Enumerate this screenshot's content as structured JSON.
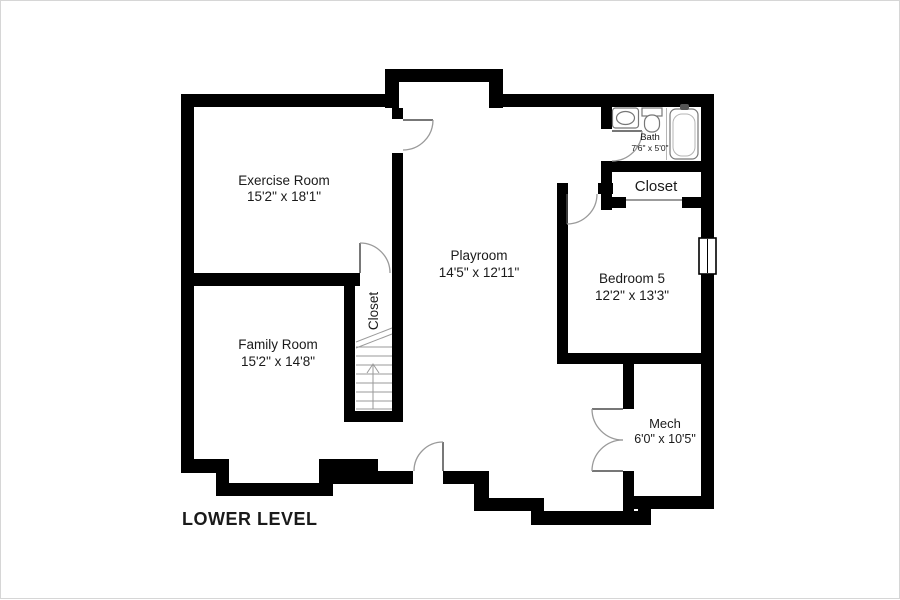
{
  "title": "LOWER LEVEL",
  "colors": {
    "wall": "#000000",
    "background": "#ffffff",
    "door": "#9a9a9a",
    "fixture": "#777777",
    "text": "#1a1a1a"
  },
  "rooms": {
    "exercise": {
      "name": "Exercise Room",
      "dims": "15'2\" x 18'1\""
    },
    "playroom": {
      "name": "Playroom",
      "dims": "14'5\" x 12'11\""
    },
    "family": {
      "name": "Family Room",
      "dims": "15'2\" x 14'8\""
    },
    "bedroom5": {
      "name": "Bedroom 5",
      "dims": "12'2\" x 13'3\""
    },
    "bath": {
      "name": "Bath",
      "dims": "7'6\" x 5'0\""
    },
    "mech": {
      "name": "Mech",
      "dims": "6'0\" x 10'5\""
    },
    "closet_hall": {
      "name": "Closet"
    },
    "closet_stairs": {
      "name": "Closet"
    }
  }
}
